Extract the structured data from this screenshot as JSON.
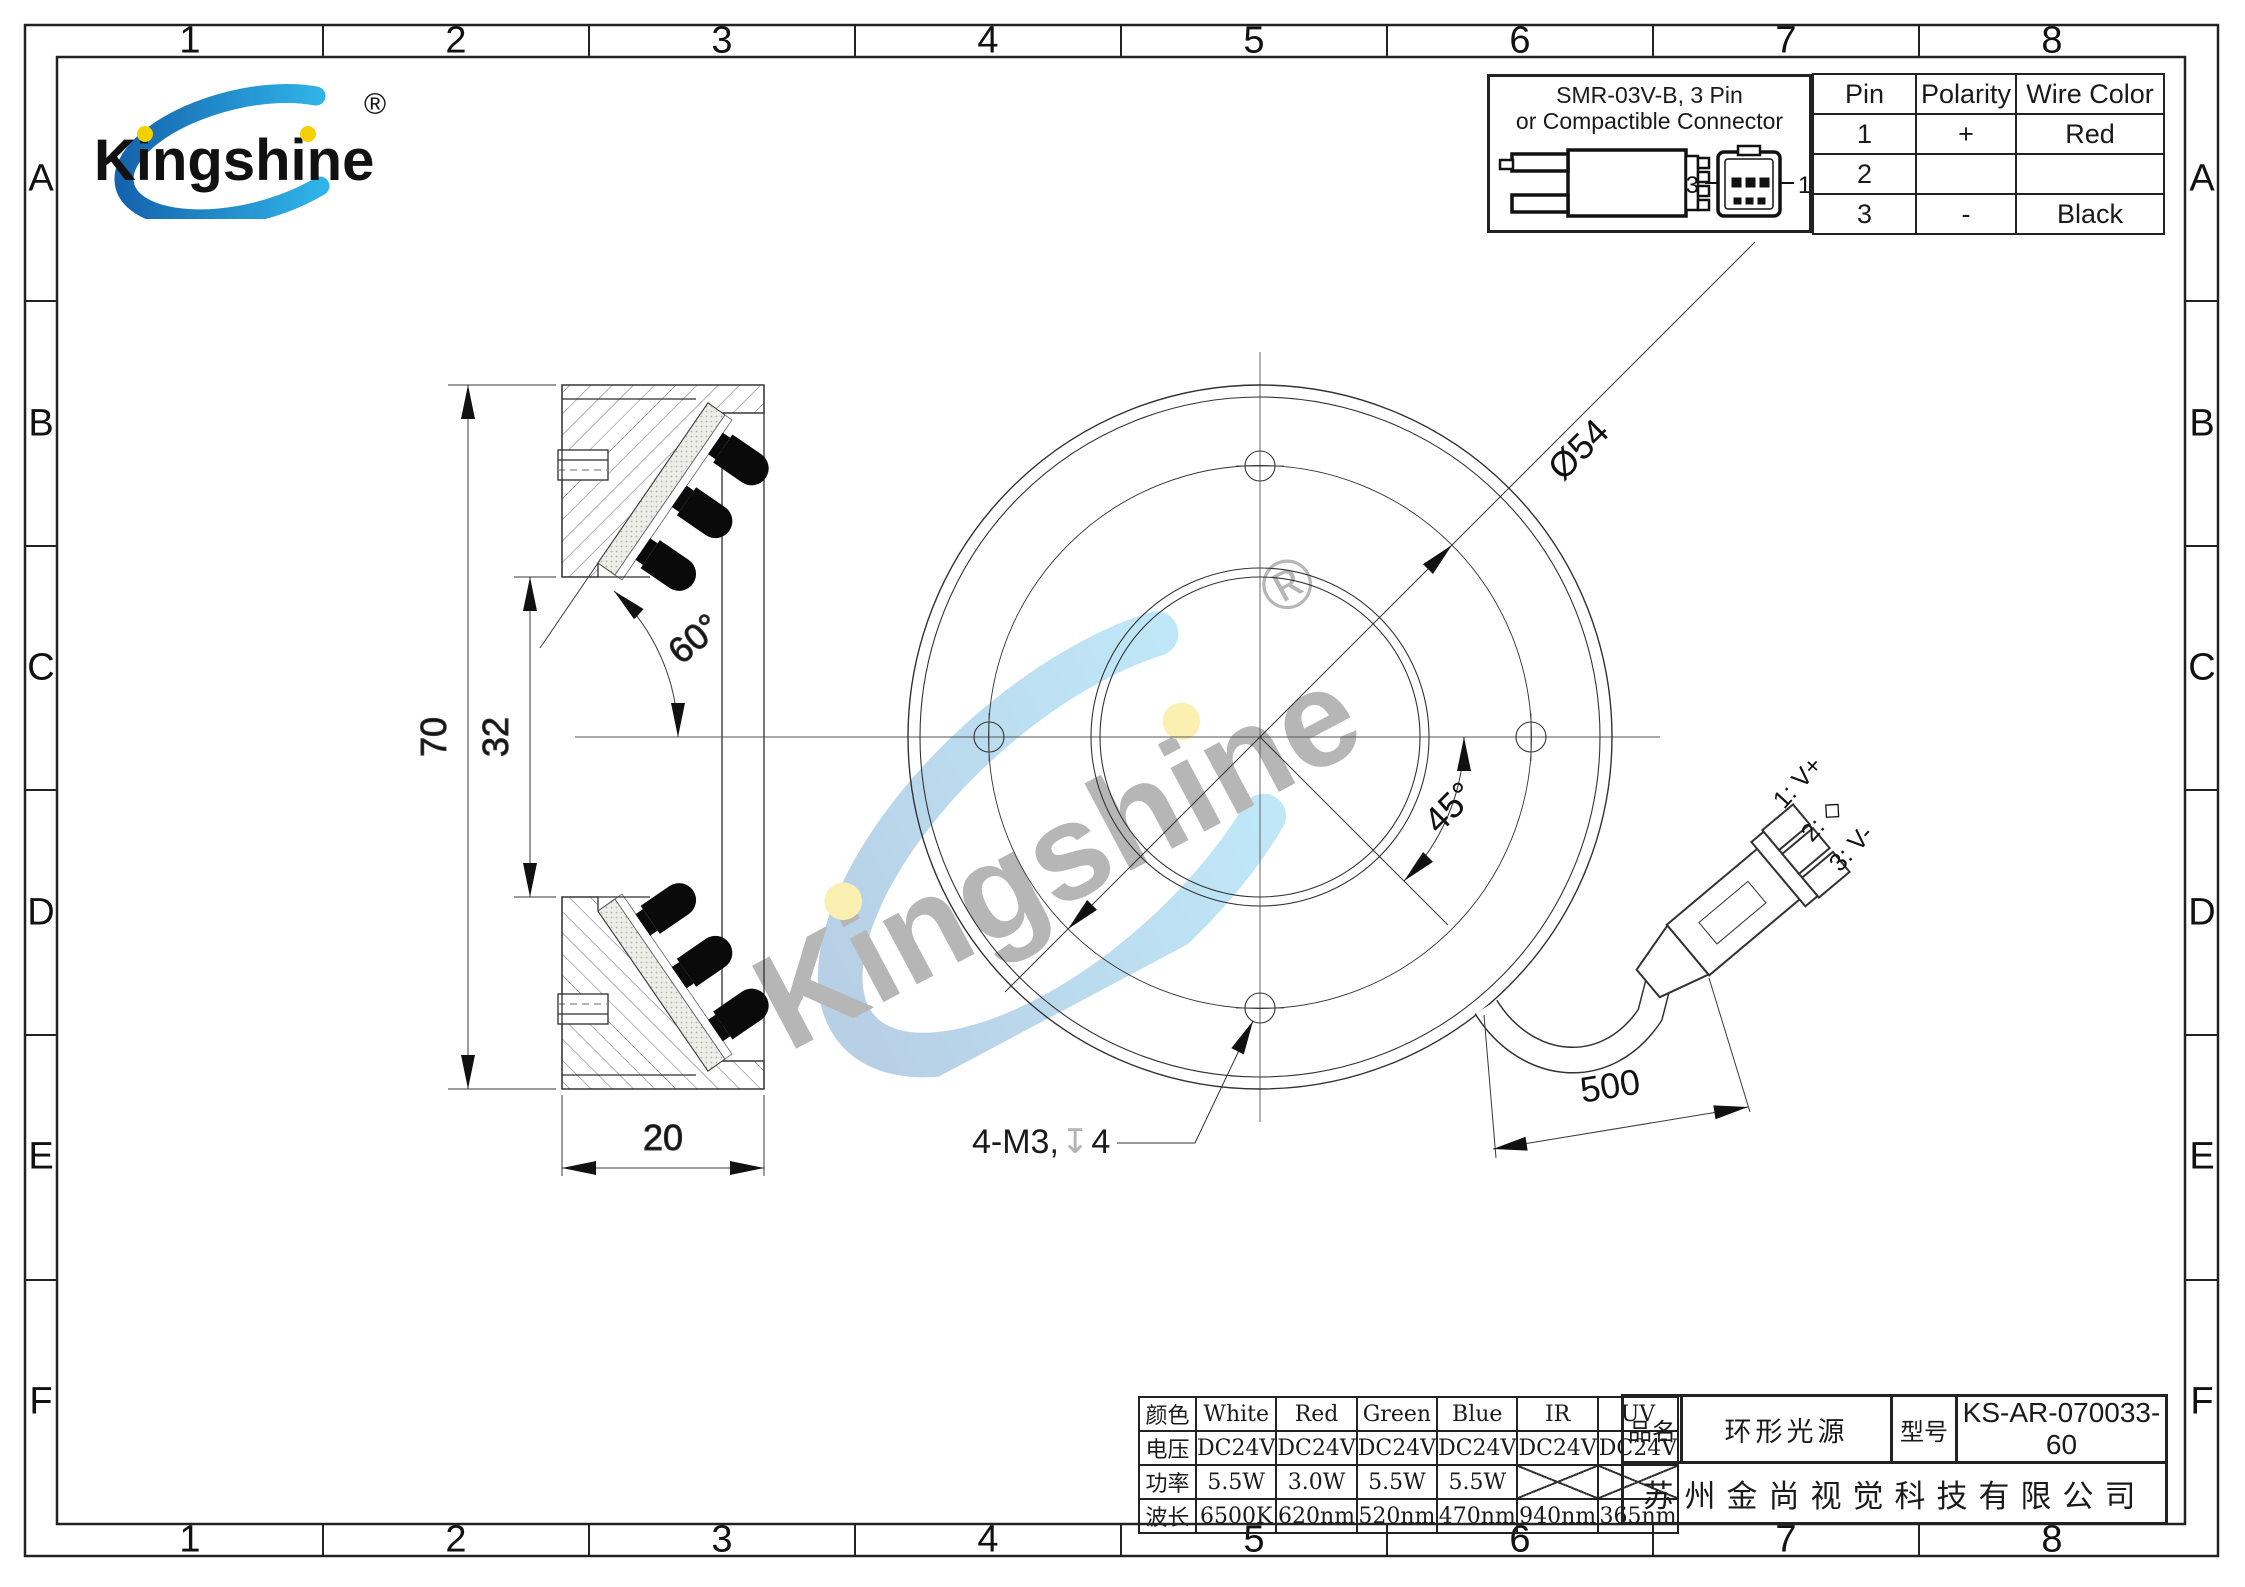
{
  "sheet": {
    "grid_columns": [
      "1",
      "2",
      "3",
      "4",
      "5",
      "6",
      "7",
      "8"
    ],
    "grid_rows": [
      "A",
      "B",
      "C",
      "D",
      "E",
      "F"
    ]
  },
  "logo": {
    "text": "Kingshine",
    "registered": "®"
  },
  "connector_spec": {
    "title_line1": "SMR-03V-B, 3 Pin",
    "title_line2": "or Compactible Connector",
    "front_pin_left": "3",
    "front_pin_right": "1"
  },
  "pin_table": {
    "headers": [
      "Pin",
      "Polarity",
      "Wire Color"
    ],
    "rows": [
      [
        "1",
        "+",
        "Red"
      ],
      [
        "2",
        "",
        ""
      ],
      [
        "3",
        "-",
        "Black"
      ]
    ]
  },
  "dimensions": {
    "overall_height": "70",
    "inner_opening": "32",
    "ring_width": "20",
    "led_angle": "60°",
    "bolt_circle": "Ø54",
    "hole_spacing_angle": "45°",
    "cable_length": "500",
    "thread_note": "4-M3,",
    "depth_symbol": "↧",
    "thread_depth": "4"
  },
  "wire_labels": {
    "pin1": "1: V+",
    "pin2": "2: ◇",
    "pin3": "3: V-"
  },
  "spec_table": {
    "rows": [
      {
        "label": "颜色",
        "values": [
          "White",
          "Red",
          "Green",
          "Blue",
          "IR",
          "UV"
        ]
      },
      {
        "label": "电压",
        "values": [
          "DC24V",
          "DC24V",
          "DC24V",
          "DC24V",
          "DC24V",
          "DC24V"
        ]
      },
      {
        "label": "功率",
        "values": [
          "5.5W",
          "3.0W",
          "5.5W",
          "5.5W",
          "",
          ""
        ]
      },
      {
        "label": "波长",
        "values": [
          "6500K",
          "620nm",
          "520nm",
          "470nm",
          "940nm",
          "365nm"
        ]
      }
    ]
  },
  "title_block": {
    "name_label": "品名",
    "name_value": "环形光源",
    "model_label": "型号",
    "model_value": "KS-AR-070033-60",
    "company": "苏州金尚视觉科技有限公司"
  },
  "colors": {
    "brand_blue": "#2aa9e0",
    "brand_dark_blue": "#1b6fb5",
    "dot_yellow": "#f5d000"
  }
}
